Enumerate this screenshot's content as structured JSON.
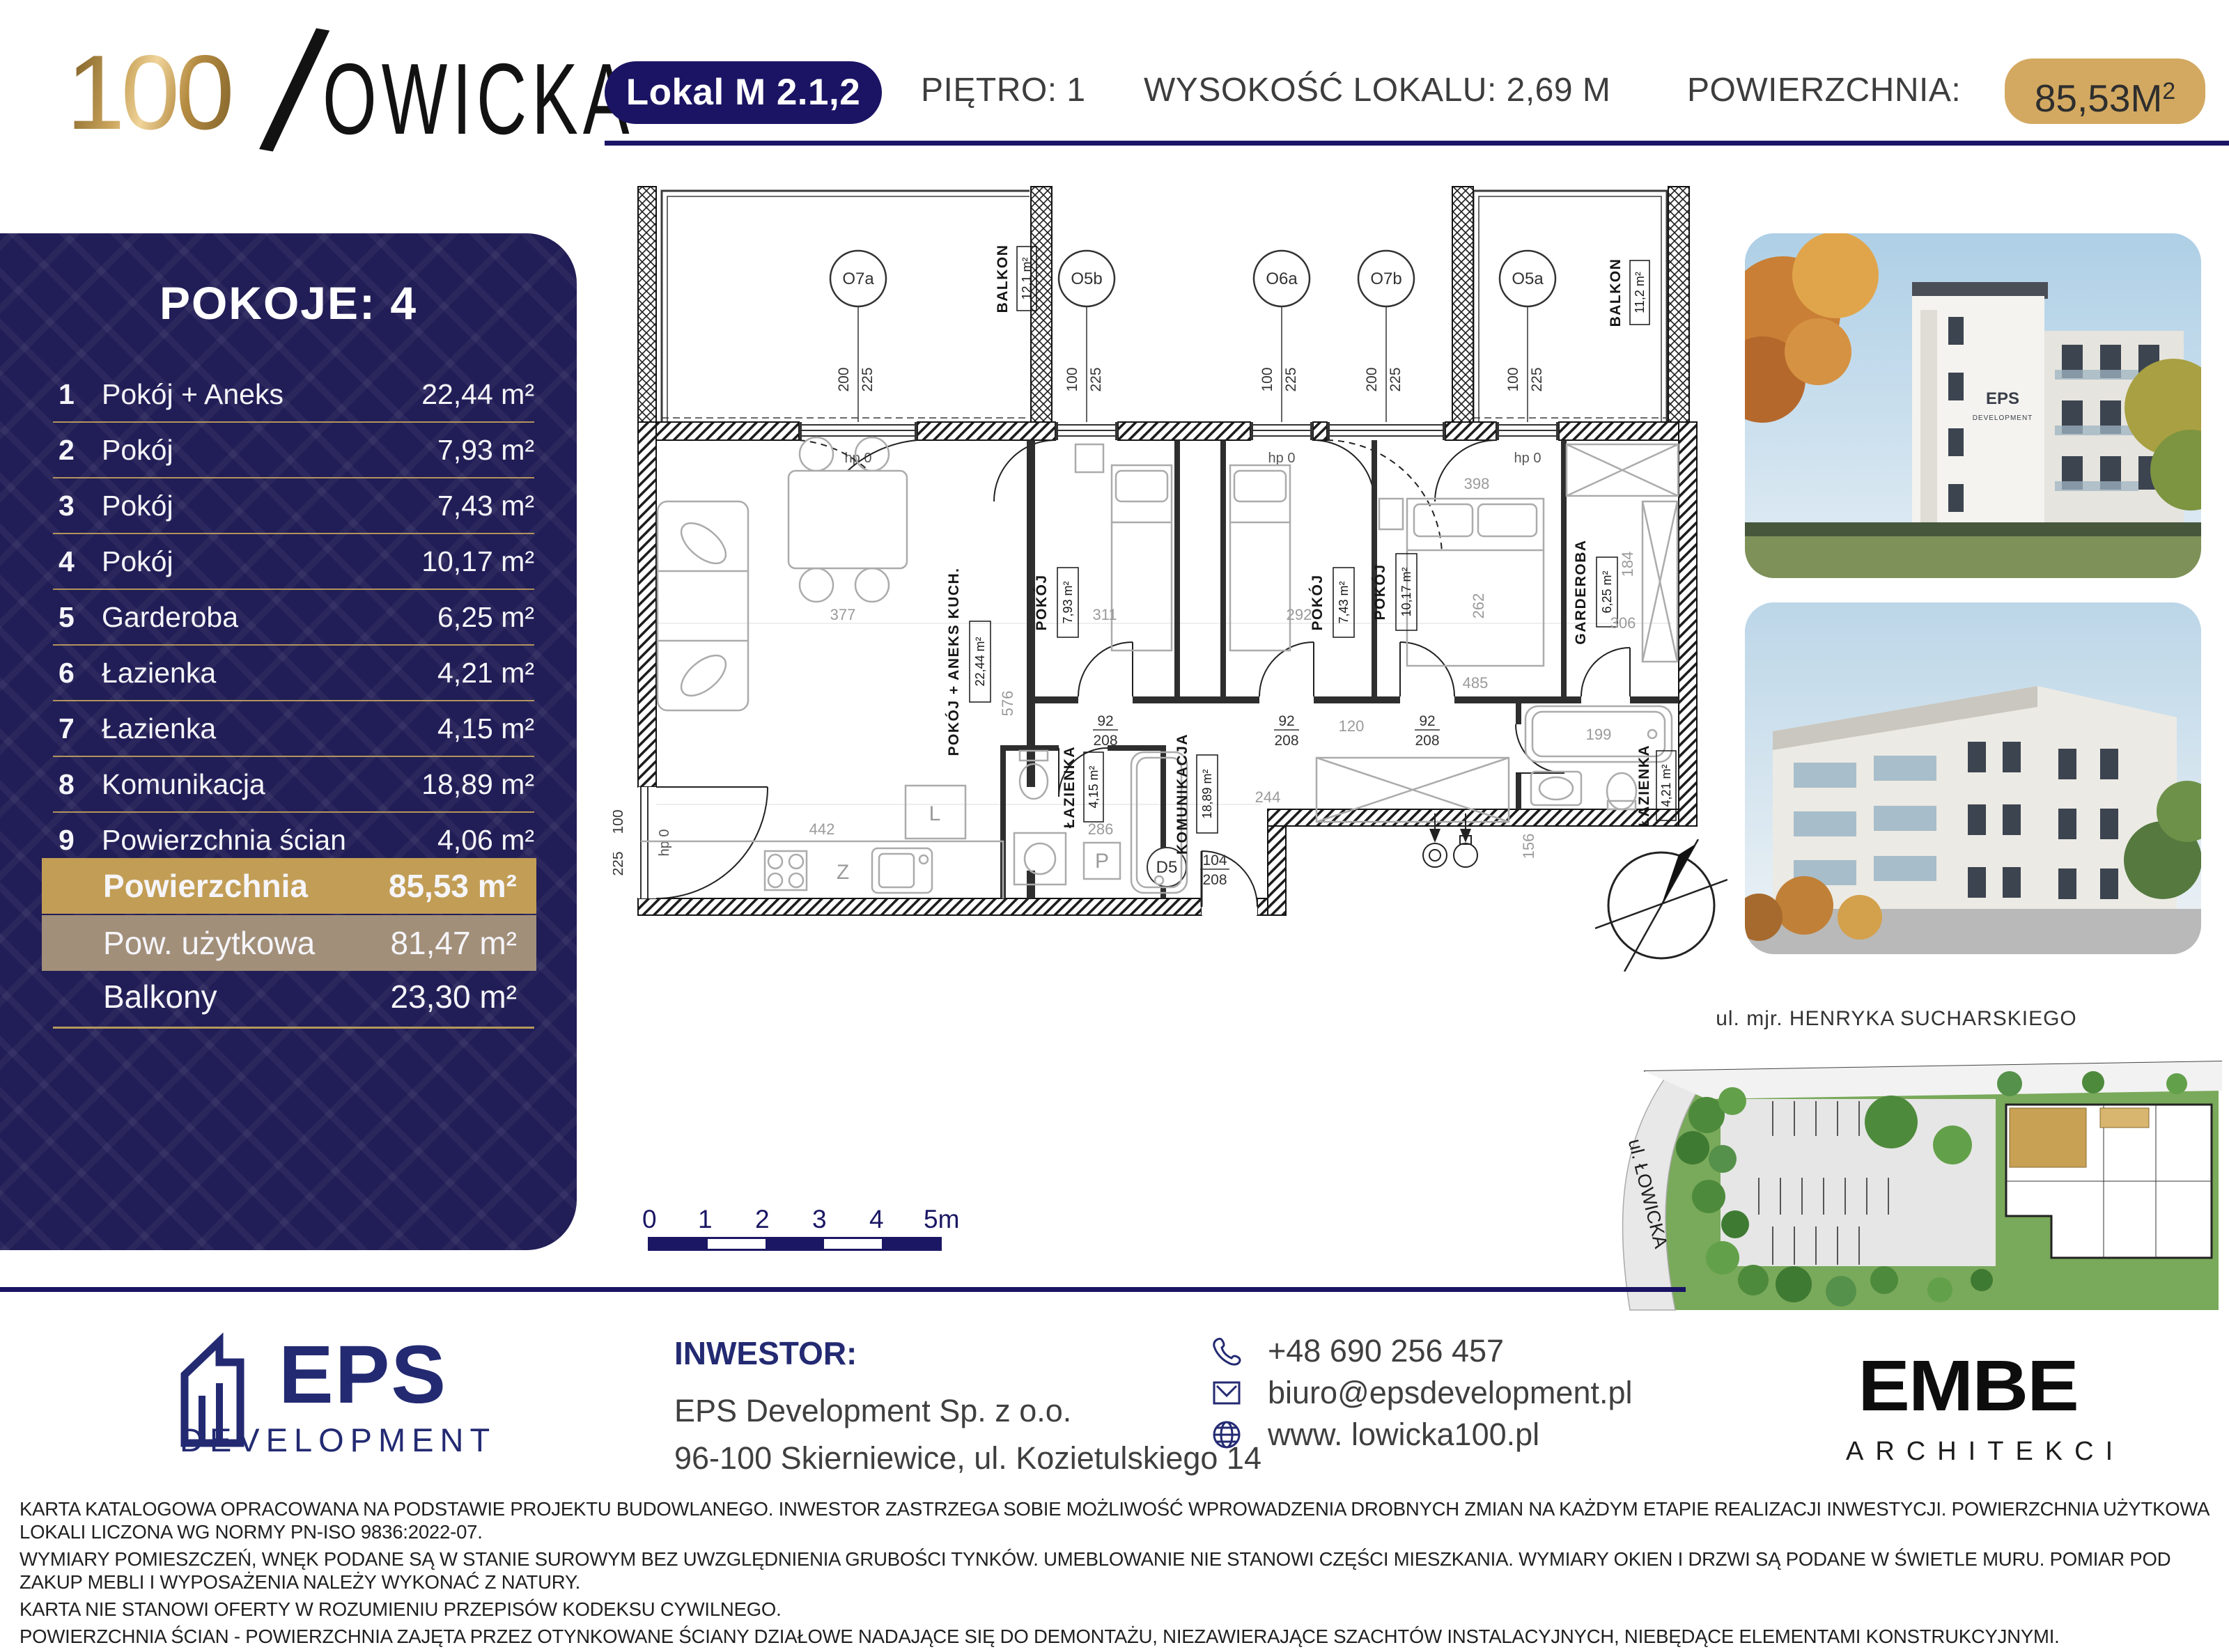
{
  "header": {
    "logo": {
      "num": "100",
      "slash": "/",
      "rest": "OWICKA"
    },
    "unit_badge": "Lokal M 2.1,2",
    "floor": "PIĘTRO: 1",
    "height": "WYSOKOŚĆ LOKALU: 2,69 M",
    "area_label": "POWIERZCHNIA:",
    "area_value": "85,53M",
    "area_sup": "2"
  },
  "sidebar": {
    "title": "POKOJE: 4",
    "rows": [
      {
        "no": "1",
        "name": "Pokój + Aneks",
        "value": "22,44 m²"
      },
      {
        "no": "2",
        "name": "Pokój",
        "value": "7,93 m²"
      },
      {
        "no": "3",
        "name": "Pokój",
        "value": "7,43 m²"
      },
      {
        "no": "4",
        "name": "Pokój",
        "value": "10,17 m²"
      },
      {
        "no": "5",
        "name": "Garderoba",
        "value": "6,25 m²"
      },
      {
        "no": "6",
        "name": "Łazienka",
        "value": "4,21 m²"
      },
      {
        "no": "7",
        "name": "Łazienka",
        "value": "4,15 m²"
      },
      {
        "no": "8",
        "name": "Komunikacja",
        "value": "18,89 m²"
      },
      {
        "no": "9",
        "name": "Powierzchnia ścian",
        "value": "4,06 m²"
      }
    ],
    "summary": [
      {
        "name": "Powierzchnia",
        "value": "85,53 m²"
      },
      {
        "name": "Pow. użytkowa",
        "value": "81,47 m²"
      },
      {
        "name": "Balkony",
        "value": "23,30 m²"
      }
    ]
  },
  "plan": {
    "rooms": [
      {
        "name": "POKÓJ + ANEKS KUCH.",
        "area": "22,44 m²"
      },
      {
        "name": "POKÓJ",
        "area": "7,93 m²"
      },
      {
        "name": "POKÓJ",
        "area": "7,43 m²"
      },
      {
        "name": "POKÓJ",
        "area": "10,17 m²"
      },
      {
        "name": "GARDEROBA",
        "area": "6,25 m²"
      },
      {
        "name": "ŁAZIENKA",
        "area": "4,21 m²"
      },
      {
        "name": "ŁAZIENKA",
        "area": "4,15 m²"
      },
      {
        "name": "KOMUNIKACJA",
        "area": "18,89 m²"
      }
    ],
    "balconies": [
      {
        "name": "BALKON",
        "area": "12,1 m²"
      },
      {
        "name": "BALKON",
        "area": "11,2 m²"
      }
    ],
    "windows": [
      {
        "id": "O7a",
        "w": "200",
        "h": "225"
      },
      {
        "id": "O5b",
        "w": "100",
        "h": "225"
      },
      {
        "id": "O6a",
        "w": "100",
        "h": "225"
      },
      {
        "id": "O7b",
        "w": "200",
        "h": "225"
      },
      {
        "id": "O5a",
        "w": "100",
        "h": "225"
      }
    ],
    "side_window": {
      "w": "100",
      "h": "225"
    },
    "entry": {
      "id": "D5",
      "w": "104",
      "h": "208"
    },
    "door_dim": {
      "w": "92",
      "h": "208"
    },
    "hp": "hp 0",
    "letters": {
      "z": "Z",
      "l": "L",
      "p": "P"
    },
    "dims": {
      "d377": "377",
      "d576": "576",
      "d442": "442",
      "d311": "311",
      "d292": "292",
      "d262": "262",
      "d398": "398",
      "d485": "485",
      "d306": "306",
      "d184": "184",
      "d244": "244",
      "d286": "286",
      "d199": "199",
      "d156": "156",
      "d120": "120"
    }
  },
  "scalebar": {
    "labels": [
      "0",
      "1",
      "2",
      "3",
      "4",
      "5m"
    ]
  },
  "siteplan": {
    "street_top": "ul. mjr. HENRYKA SUCHARSKIEGO",
    "street_left": "ul. ŁOWICKA"
  },
  "footer": {
    "eps_logo": {
      "name": "EPS",
      "sub": "DEVELOPMENT"
    },
    "investor_label": "INWESTOR:",
    "investor_name": "EPS Development Sp. z o.o.",
    "investor_address": "96-100 Skierniewice, ul. Kozietulskiego 14",
    "phone": "+48 690 256 457",
    "email": "biuro@epsdevelopment.pl",
    "website": "www. lowicka100.pl",
    "embe_logo": {
      "name": "EMBE",
      "sub": "ARCHITEKCI"
    }
  },
  "disclaimer": {
    "l1": "KARTA KATALOGOWA OPRACOWANA NA PODSTAWIE PROJEKTU BUDOWLANEGO. INWESTOR ZASTRZEGA SOBIE MOŻLIWOŚĆ WPROWADZENIA DROBNYCH ZMIAN NA KAŻDYM ETAPIE REALIZACJI INWESTYCJI. POWIERZCHNIA UŻYTKOWA LOKALI LICZONA WG NORMY PN-ISO 9836:2022-07.",
    "l2": "WYMIARY POMIESZCZEŃ, WNĘK PODANE SĄ W STANIE SUROWYM BEZ UWZGLĘDNIENIA GRUBOŚCI TYNKÓW. UMEBLOWANIE NIE STANOWI CZĘŚCI MIESZKANIA. WYMIARY OKIEN I DRZWI SĄ PODANE W ŚWIETLE MURU. POMIAR POD ZAKUP MEBLI I WYPOSAŻENIA NALEŻY WYKONAĆ Z NATURY.",
    "l3": "KARTA NIE STANOWI OFERTY W ROZUMIENIU PRZEPISÓW KODEKSU CYWILNEGO.",
    "l4": "POWIERZCHNIA ŚCIAN - POWIERZCHNIA ZAJĘTA PRZEZ OTYNKOWANE ŚCIANY DZIAŁOWE NADAJĄCE SIĘ DO DEMONTAŻU, NIEZAWIERAJĄCE SZACHTÓW INSTALACYJNYCH, NIEBĘDĄCE ELEMENTAMI KONSTRUKCYJNYMI."
  }
}
